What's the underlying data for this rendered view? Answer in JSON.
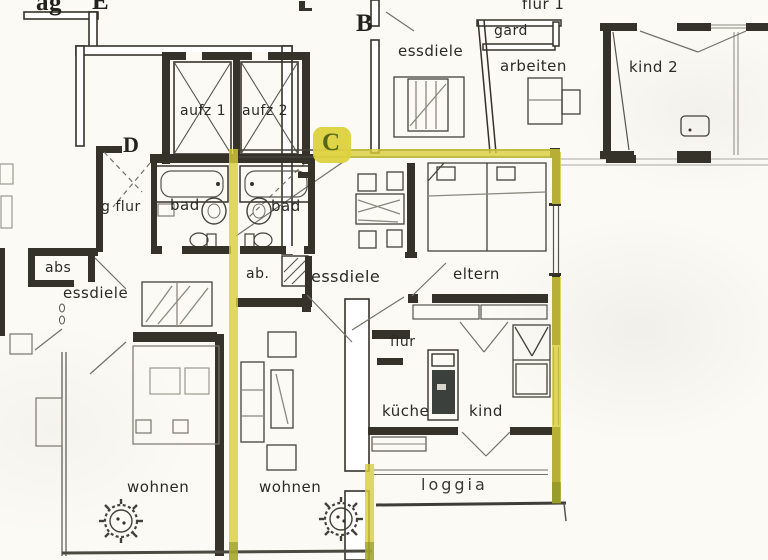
{
  "title": "apartment floor plan scan, unit C outlined with yellow highlighter",
  "colors": {
    "paper": "#fbfaf5",
    "ink": "#343229",
    "thin_line": "#55544e",
    "highlight_yellow": "#d8ce3a",
    "highlight_olive_tip": "#7c8a1e",
    "unit_c_letter": "#55651a"
  },
  "markers": {
    "b": "B",
    "c": "C",
    "d": "D",
    "e": "E",
    "edge_fragment": "ag"
  },
  "rooms": {
    "flur1": "flur 1",
    "gard": "gard",
    "arbeiten": "arbeiten",
    "kind2": "kind 2",
    "essdiele_b": "essdiele",
    "aufz1": "aufz 1",
    "aufz2": "aufz 2",
    "g_flur": "g flur",
    "bad_left": "bad",
    "bad_right": "bad",
    "abs": "abs",
    "essdiele_d": "essdiele",
    "ab": "ab.",
    "essdiele_c": "essdiele",
    "eltern": "eltern",
    "flur_c": "flur",
    "kueche": "küche",
    "kind_c": "kind",
    "wohnen_d": "wohnen",
    "wohnen_c": "wohnen",
    "loggia": "loggia"
  }
}
